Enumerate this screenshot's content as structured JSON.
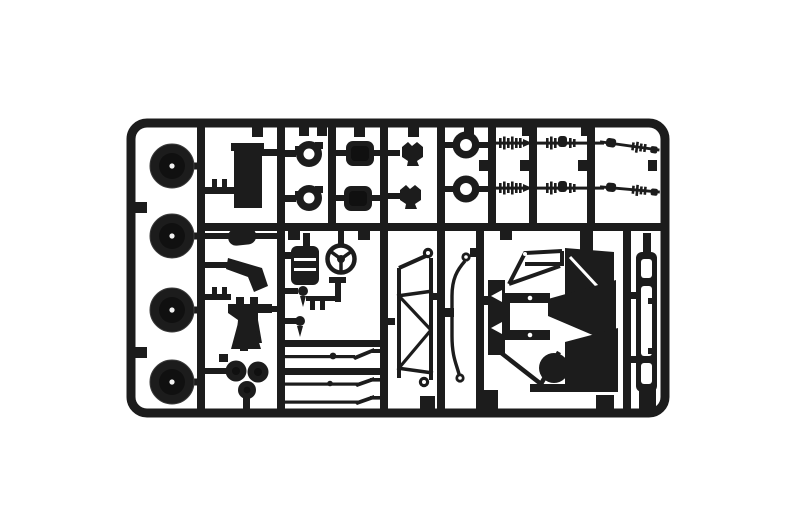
{
  "scene": {
    "type": "product-photo",
    "subject": "Black plastic model kit sprue (injection-molded parts tree) photographed on a plain white background",
    "background_color": "#ffffff",
    "plastic_color": "#1c1c1c",
    "plastic_shadow_color": "#101010",
    "hub_hole_color": "#f2f2f2"
  },
  "sprue": {
    "frame": "rounded rectangular outer runner frame with internal vertical and horizontal runners forming cells",
    "parts": [
      {
        "name": "wheel-part",
        "count": 4,
        "desc": "round wheels/tires with center hub hole, left column"
      },
      {
        "name": "fuel-tank-part",
        "count": 1,
        "desc": "tall rectangular tank block"
      },
      {
        "name": "hub-ring-part",
        "count": 2,
        "desc": "flanged donut hubs with center holes"
      },
      {
        "name": "axle-housing-part",
        "count": 2,
        "desc": "rounded square housing blocks"
      },
      {
        "name": "clip-part",
        "count": 2,
        "desc": "small spring clip brackets"
      },
      {
        "name": "flanged-ring-part",
        "count": 2,
        "desc": "round flanged rings with center holes"
      },
      {
        "name": "drive-shaft-part",
        "count": 2,
        "desc": "long splined drive shafts with universal joints, top right"
      },
      {
        "name": "seat-stack-part",
        "count": 1,
        "desc": "ribbed block part"
      },
      {
        "name": "steering-wheel-part",
        "count": 1,
        "desc": "three-spoke steering wheel"
      },
      {
        "name": "horn-lever-part",
        "count": 1,
        "desc": "T-shaped lever linkage"
      },
      {
        "name": "shift-lever-part",
        "count": 2,
        "desc": "small knobbed levers"
      },
      {
        "name": "pad-part",
        "count": 1,
        "desc": "small oval pad"
      },
      {
        "name": "exhaust-bracket-part",
        "count": 1,
        "desc": "angled bracket"
      },
      {
        "name": "engine-block-part",
        "count": 1,
        "desc": "stepped block part"
      },
      {
        "name": "funnel-part",
        "count": 1,
        "desc": "flared funnel shape"
      },
      {
        "name": "pulley-cluster-part",
        "count": 1,
        "desc": "cluster of three round pulleys"
      },
      {
        "name": "tie-rod-part",
        "count": 3,
        "desc": "thin horizontal linkage rods with blade ends"
      },
      {
        "name": "truss-frame-part",
        "count": 1,
        "desc": "zig-zag trussed side frame with eyelet ends"
      },
      {
        "name": "brake-line-part",
        "count": 1,
        "desc": "long curved rod with eyelets at both ends"
      },
      {
        "name": "chassis-assembly-part",
        "count": 1,
        "desc": "large complex chassis/front-frame assembly"
      },
      {
        "name": "frame-rail-part",
        "count": 1,
        "desc": "long slotted ladder frame rail, right edge"
      }
    ]
  }
}
